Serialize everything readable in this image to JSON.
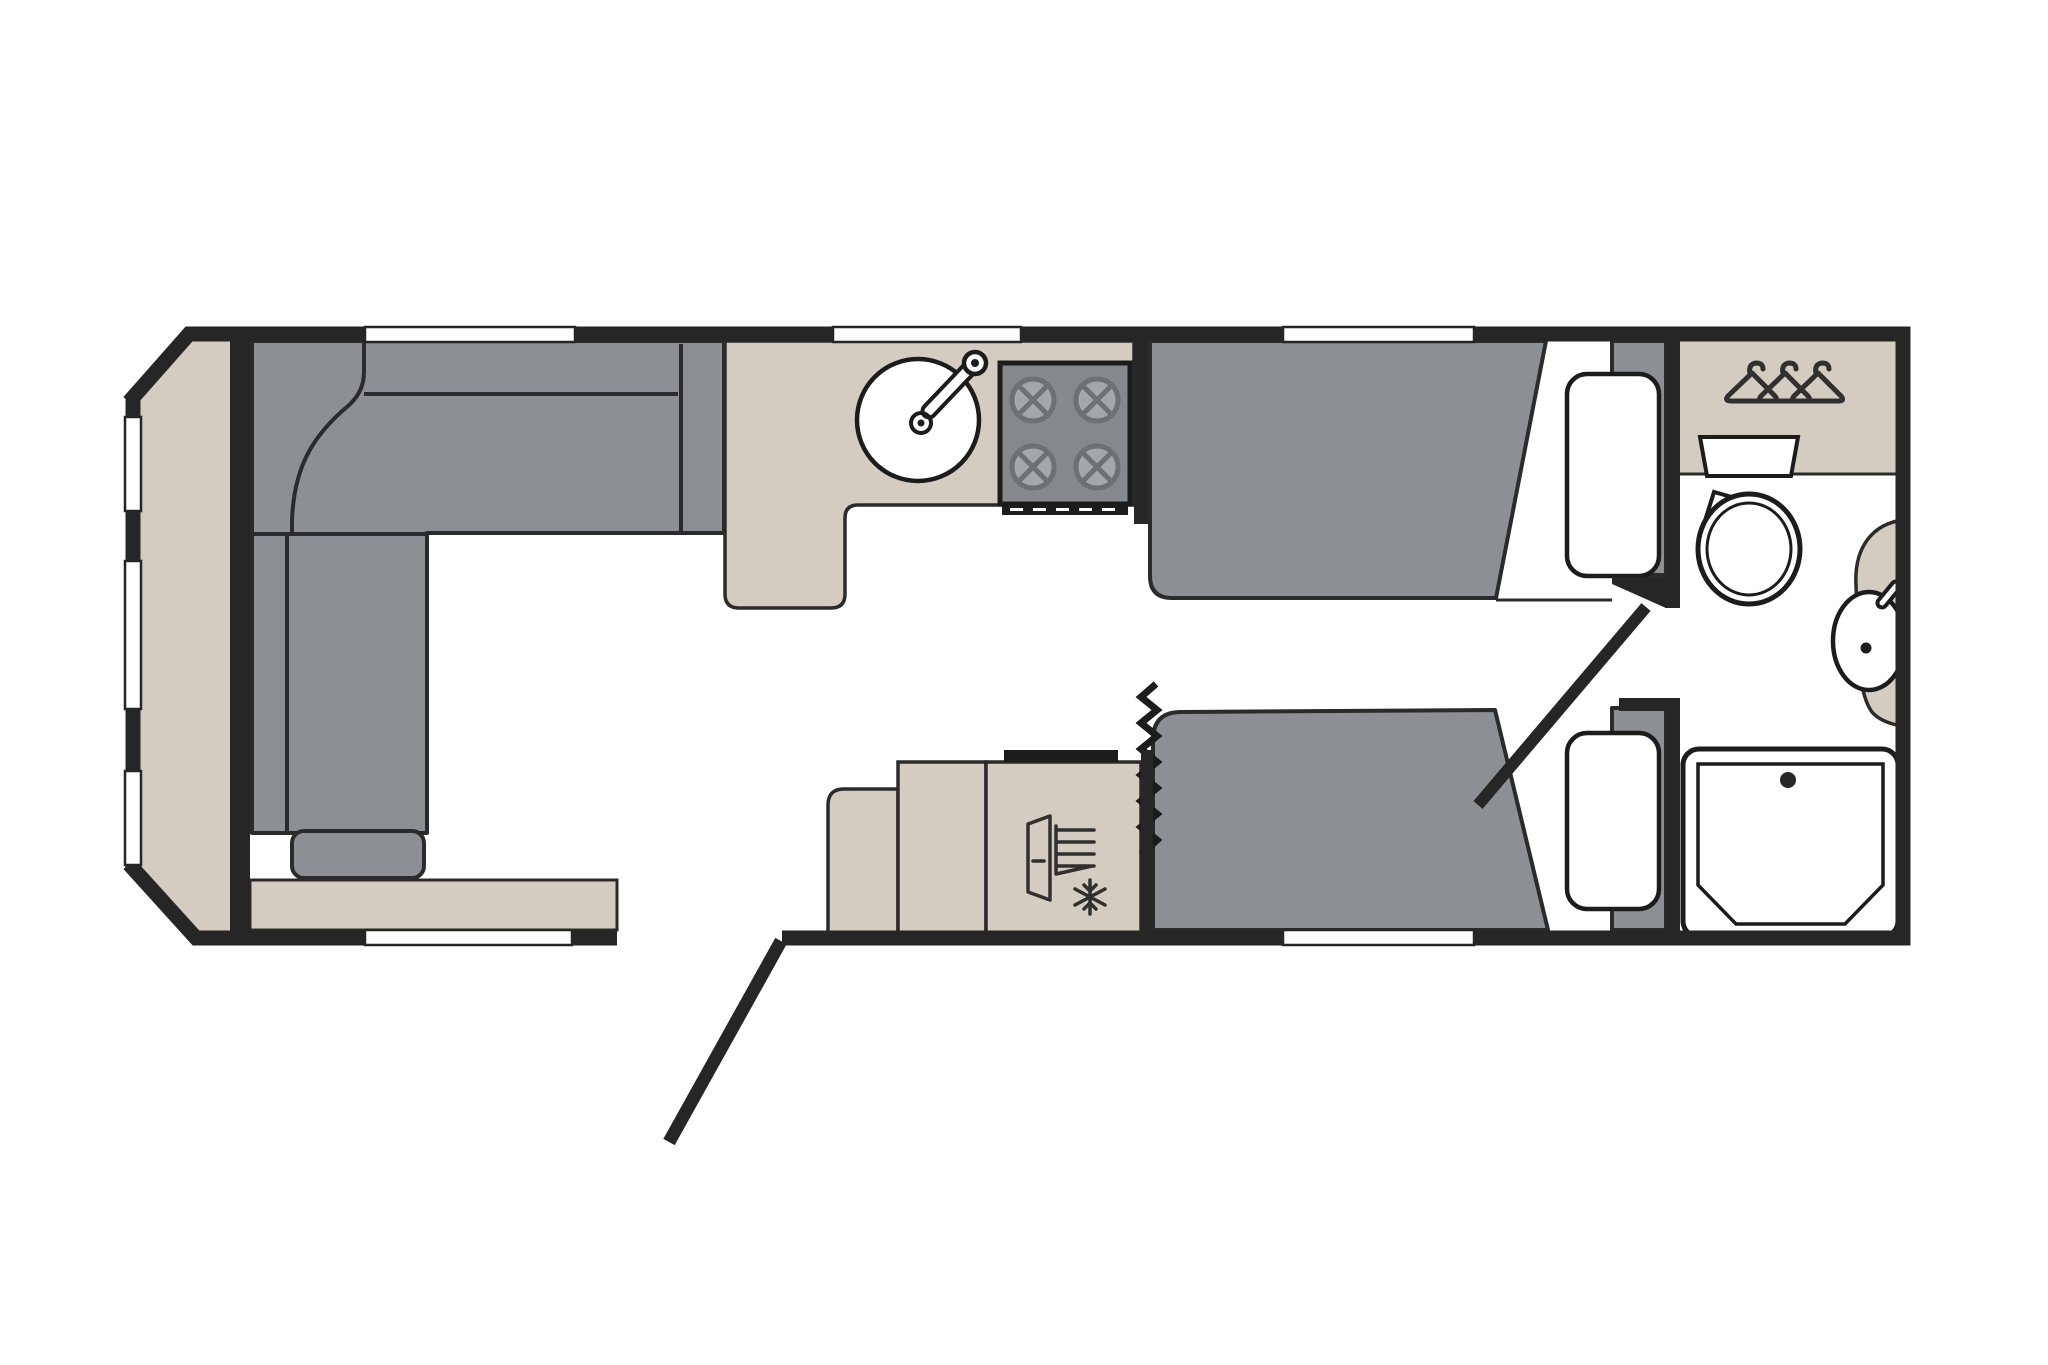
{
  "title": "Caravan floor plan",
  "type": "floorplan-diagram",
  "colors": {
    "wall": "#262626",
    "line": "#2b2b2b",
    "icon": "#303030",
    "furniture_gray": "#8c8f93",
    "hob_gray": "#85888c",
    "burner_fill": "#a4a7ab",
    "burner_line": "#6d7074",
    "cabinet_beige": "#d4ccc1",
    "white": "#ffffff",
    "background": "#ffffff"
  },
  "areas": {
    "lounge": {
      "name": "Front lounge",
      "furniture": [
        "L-shaped sofa",
        "corner cushion",
        "end cushion",
        "seat cushion",
        "front shelf"
      ]
    },
    "kitchen": {
      "name": "Kitchen",
      "fixtures": [
        "worktop",
        "round sink with tap",
        "four-burner hob",
        "grill vent"
      ]
    },
    "galley": {
      "name": "Mid units",
      "fixtures": [
        "step unit",
        "cabinet",
        "fridge freezer"
      ]
    },
    "bedroom": {
      "name": "Twin single beds",
      "fixtures": [
        "offside bed with pillow",
        "nearside bed with pillow",
        "concertina divider"
      ]
    },
    "bathroom": {
      "name": "End washroom",
      "fixtures": [
        "wardrobe with hangers",
        "toilet",
        "corner basin with tap",
        "shower tray"
      ]
    }
  },
  "doors": {
    "entry_door": 1,
    "washroom_door": 1
  },
  "windows": {
    "front_wall": 3,
    "offside_wall": 3,
    "nearside_wall": 2
  }
}
